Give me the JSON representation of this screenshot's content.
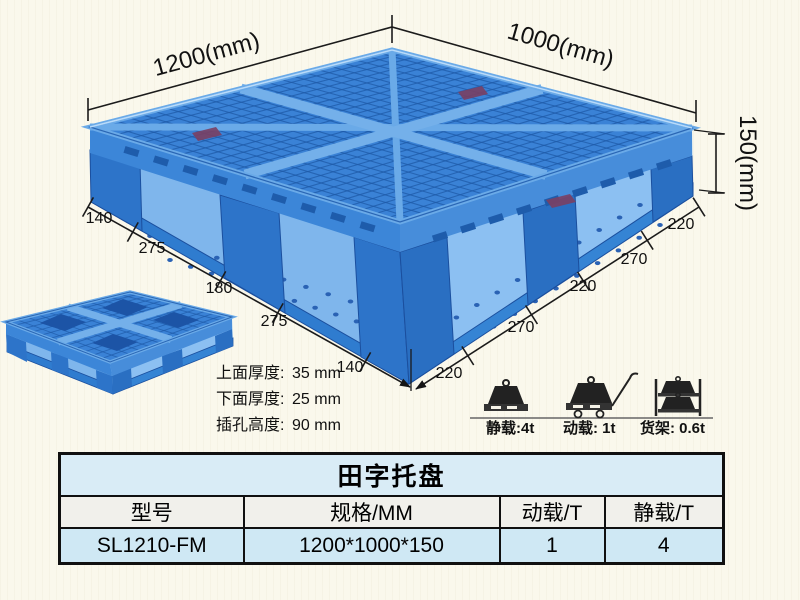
{
  "page": {
    "bg_color": "#faf7ea"
  },
  "diagram": {
    "dim_width": "1200(mm)",
    "dim_depth": "1000(mm)",
    "dim_height": "150(mm)",
    "left_edge_dims": [
      "140",
      "275",
      "180",
      "275",
      "140"
    ],
    "right_edge_dims": [
      "220",
      "270",
      "220",
      "270",
      "220"
    ],
    "specs": [
      {
        "label": "上面厚度:",
        "value": "35 mm"
      },
      {
        "label": "下面厚度:",
        "value": "25 mm"
      },
      {
        "label": "插孔高度:",
        "value": "90 mm"
      }
    ],
    "loads": [
      {
        "icon": "static-load-icon",
        "label": "静载:4t"
      },
      {
        "icon": "dynamic-load-icon",
        "label": "动载: 1t"
      },
      {
        "icon": "rack-load-icon",
        "label": "货架: 0.6t"
      }
    ],
    "pallet_color": "#3a82d6",
    "pallet_dark": "#1e5aa8",
    "pallet_light": "#7ab4ec"
  },
  "table": {
    "title": "田字托盘",
    "headers": [
      "型号",
      "规格/MM",
      "动载/T",
      "静载/T"
    ],
    "rows": [
      [
        "SL1210-FM",
        "1200*1000*150",
        "1",
        "4"
      ]
    ],
    "title_bg": "#d9ecf6",
    "header_bg": "#f1f0eb",
    "body_bg": "#cfe8f4"
  }
}
